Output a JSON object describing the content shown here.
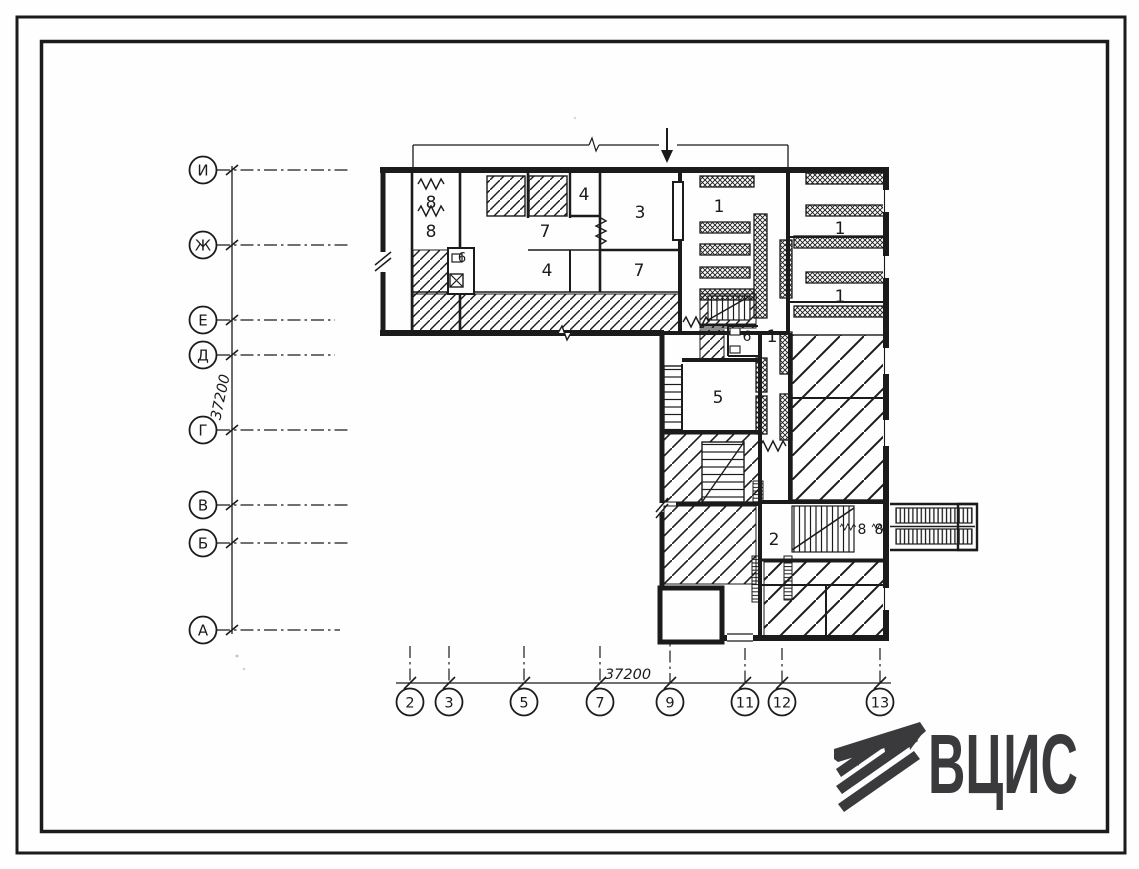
{
  "axes": {
    "left": {
      "dimension": "37200",
      "labels": [
        "И",
        "Ж",
        "Е",
        "Д",
        "Г",
        "В",
        "Б",
        "А"
      ]
    },
    "bottom": {
      "dimension": "37200",
      "labels": [
        "2",
        "3",
        "5",
        "7",
        "9",
        "11",
        "12",
        "13"
      ]
    }
  },
  "rooms": {
    "labels": [
      "8",
      "8",
      "7",
      "4",
      "3",
      "6",
      "4",
      "7",
      "1",
      "1",
      "1",
      "6",
      "1",
      "5",
      "2",
      "8",
      "8"
    ]
  },
  "logo": {
    "text": "ВЦИС"
  },
  "colors": {
    "ink": "#1b1b1b",
    "logo": "#3a3a3c",
    "paper": "#fefefe"
  }
}
